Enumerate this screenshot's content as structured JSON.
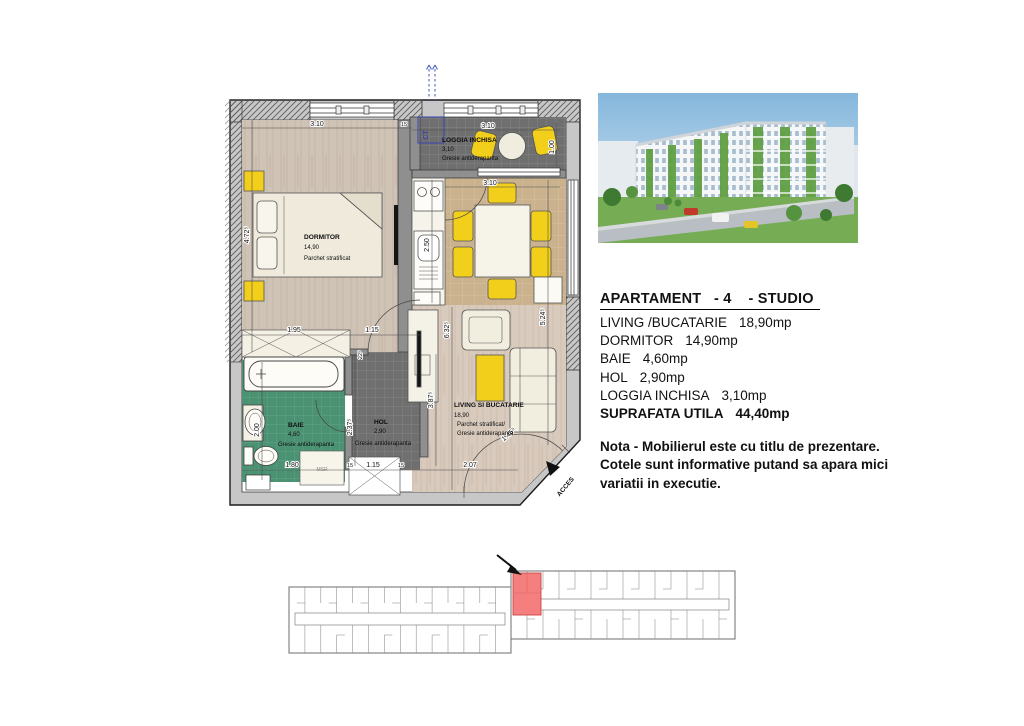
{
  "plan": {
    "rooms": {
      "dormitor": {
        "name": "DORMITOR",
        "area": "14,90",
        "floor": "Parchet stratificat"
      },
      "loggia": {
        "name": "LOGGIA INCHISA",
        "area": "3,10",
        "floor": "Gresie antiderapanta"
      },
      "baie": {
        "name": "BAIE",
        "area": "4,60",
        "floor": "Gresie antiderapanta"
      },
      "hol": {
        "name": "HOL",
        "area": "2,90",
        "floor": "Gresie antiderapanta"
      },
      "living": {
        "name": "LIVING SI BUCATARIE",
        "area": "18,90",
        "floor1": "Parchet stratificat/",
        "floor2": "Gresie antiderapanta"
      }
    },
    "dims": {
      "dormitor_w": "3.10",
      "wall15": "15",
      "loggia_w": "3.10",
      "dining_w": "3.10",
      "dormitor_h": "4.72⁵",
      "loggia_d": "1.00",
      "kitchen_h": "2.50",
      "living_h2": "5.24⁵",
      "living_h": "6.32⁵",
      "cabinet_h": "3.87⁵",
      "hol_h": "2.37⁵",
      "baie_h": "2.00",
      "door": "22⁵",
      "wardrobe_w": "1.95",
      "hol_w": "1.15",
      "baie_w": "1.80",
      "w15a": "15",
      "closet_w": "1.15",
      "w15b": "15",
      "living_w": "2.07",
      "entry_w": "1.46⁵"
    },
    "ct_label": "CT",
    "msr_label": "MSR",
    "acces_label": "ACCES"
  },
  "details": {
    "title": "APARTAMENT   - 4    - STUDIO",
    "rows": [
      {
        "label": "LIVING /BUCATARIE",
        "value": "18,90mp"
      },
      {
        "label": "DORMITOR",
        "value": "14,90mp"
      },
      {
        "label": "BAIE",
        "value": "4,60mp"
      },
      {
        "label": "HOL",
        "value": "2,90mp"
      },
      {
        "label": "LOGGIA INCHISA",
        "value": "3,10mp"
      }
    ],
    "total_label": "SUPRAFATA UTILA",
    "total_value": "44,40mp"
  },
  "note": {
    "line1": "Nota -  Mobilierul este cu titlu de prezentare.",
    "line2": "Cotele sunt informative putand sa apara mici",
    "line3": "variatii in executie."
  },
  "colors": {
    "highlight_red": "#f57e7e",
    "yellow": "#f2cf1a",
    "green_tile": "#4b9273",
    "dark_tile": "#6f6f6f",
    "tan_tile": "#c9b28d",
    "blue_ct": "#3946b0"
  }
}
